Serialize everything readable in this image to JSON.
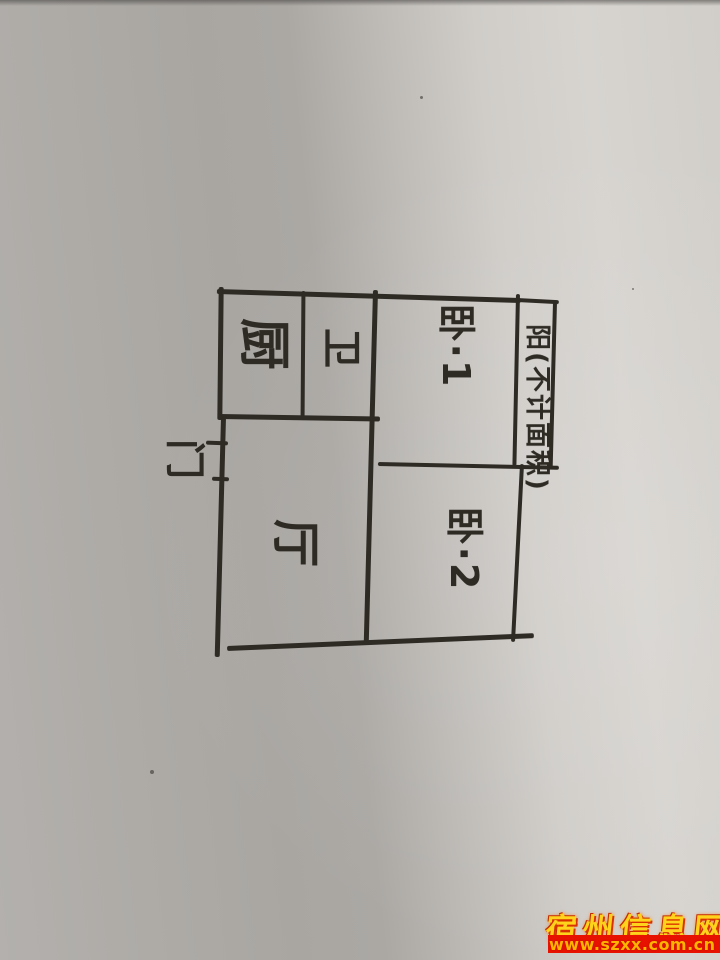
{
  "floor_plan": {
    "rooms": [
      {
        "id": "kitchen",
        "label": "厨"
      },
      {
        "id": "bathroom",
        "label": "卫"
      },
      {
        "id": "bedroom-1",
        "label": "卧·1"
      },
      {
        "id": "bedroom-2",
        "label": "卧·2"
      },
      {
        "id": "living-room",
        "label": "厅"
      },
      {
        "id": "balcony",
        "label": "阳(不计面积)"
      },
      {
        "id": "entry-door",
        "label": "门"
      }
    ],
    "ink_color": "#2e2a24"
  },
  "watermark": {
    "site_name": "宿州信息网",
    "url": "www.szxx.com.cn",
    "gold_color": "#ffd21c",
    "red_color": "#e81200"
  },
  "paper": {
    "light_color": "#d6d3cf",
    "shadow_color": "#a8a5a1"
  }
}
